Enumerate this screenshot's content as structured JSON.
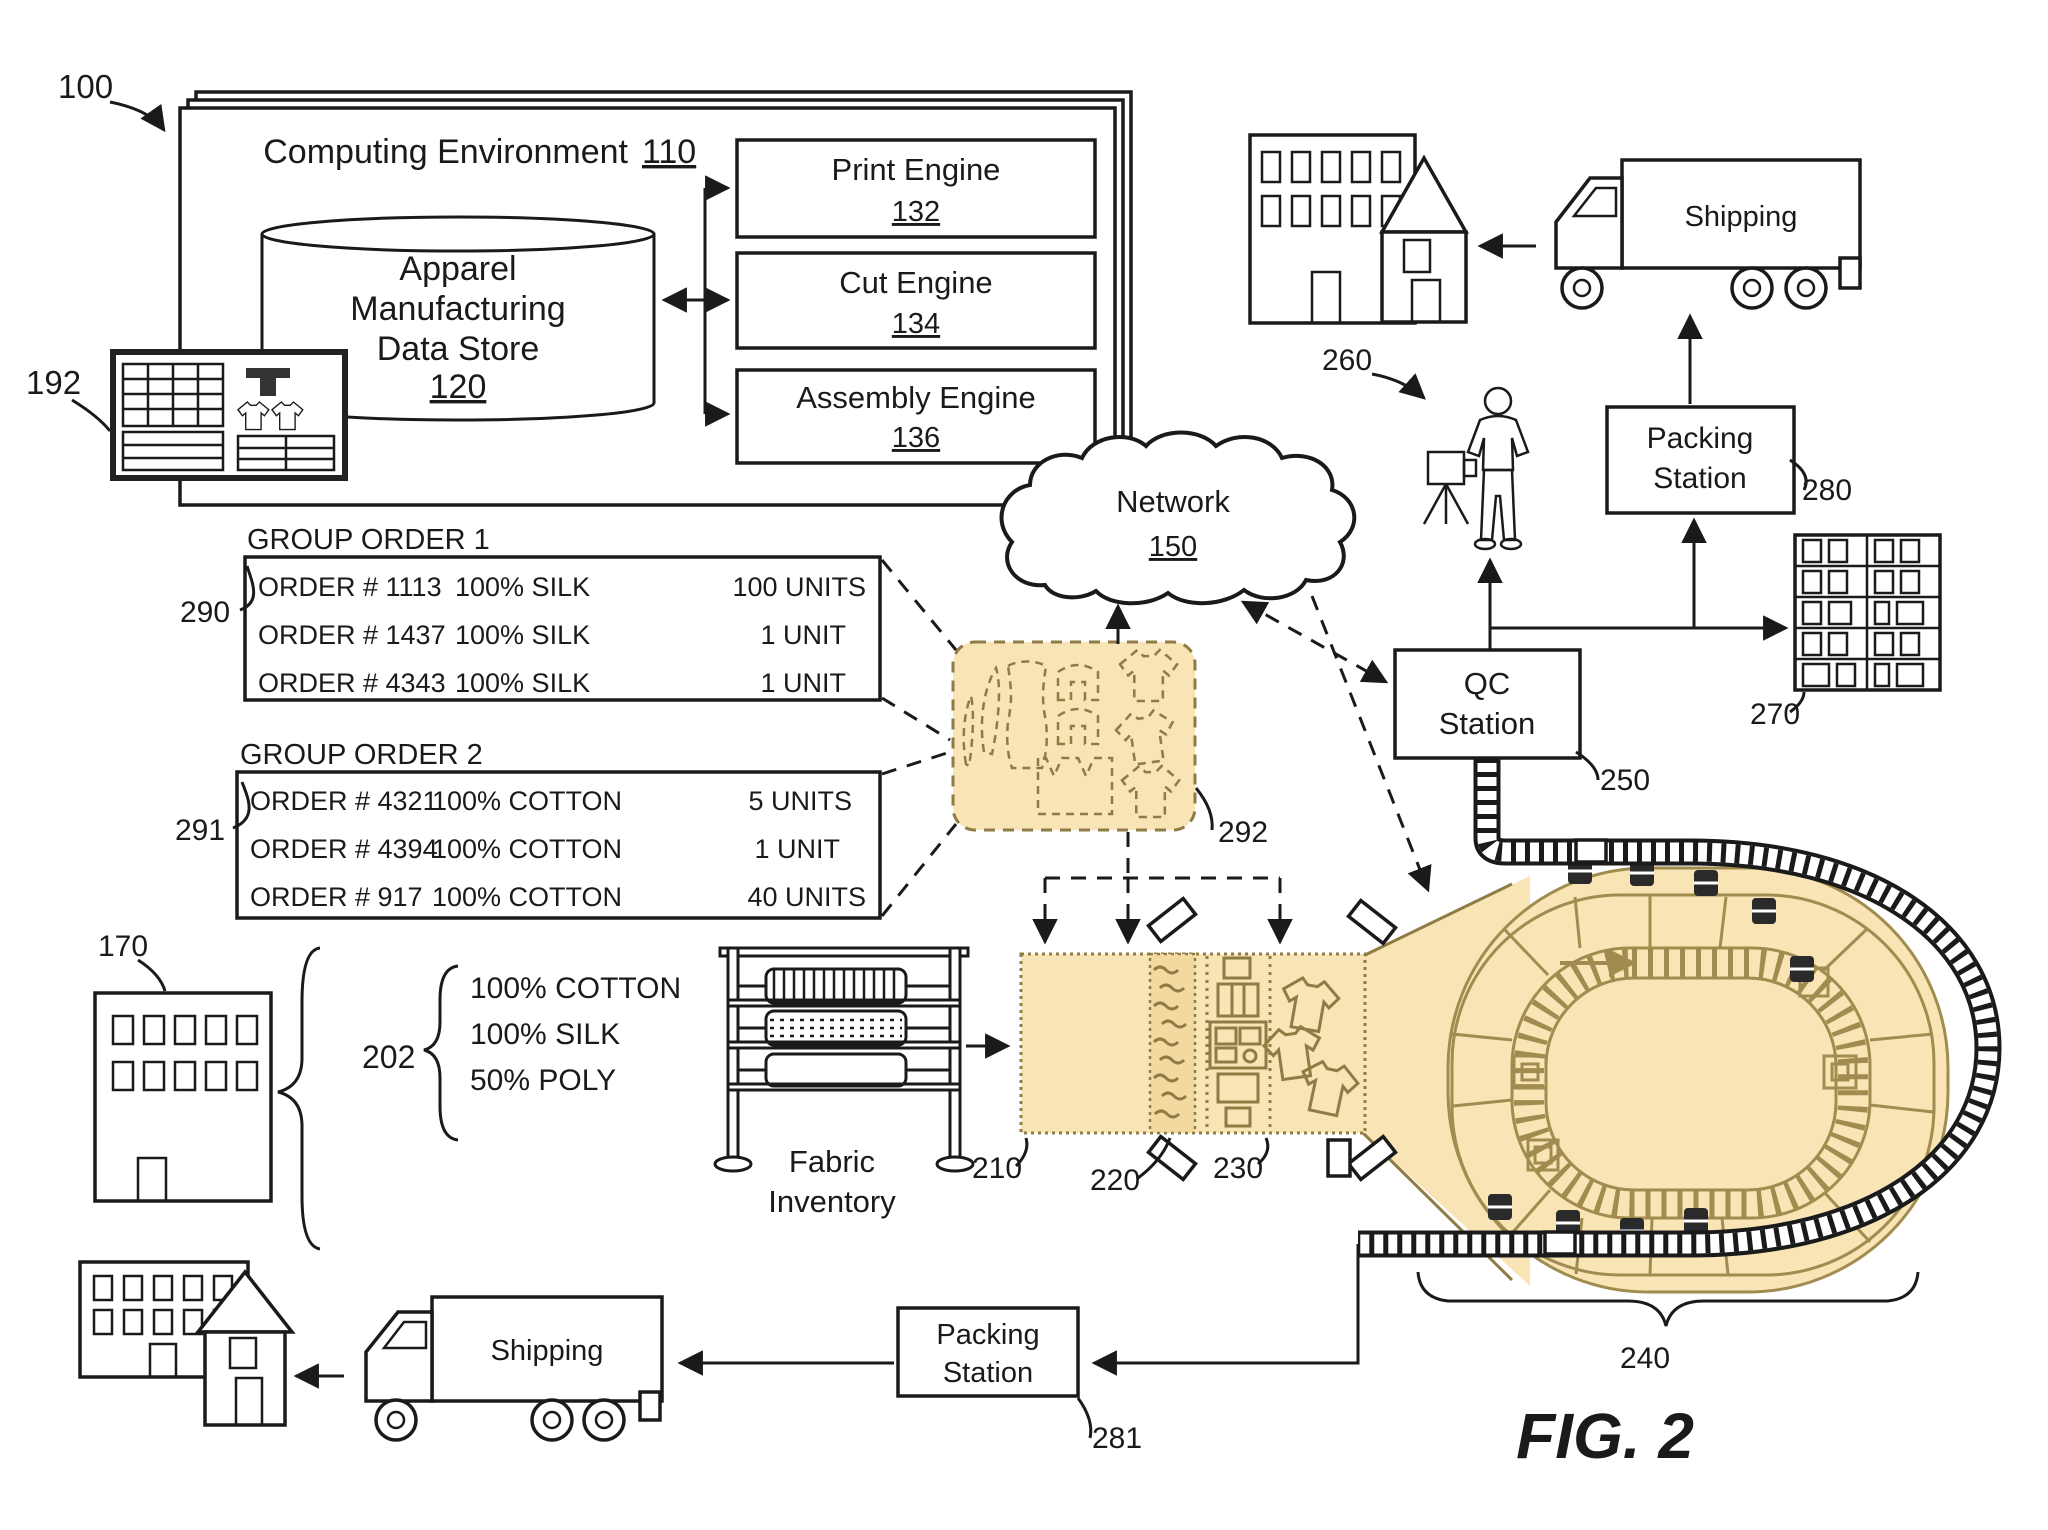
{
  "figure": {
    "system_ref": "100",
    "caption": "FIG. 2"
  },
  "colors": {
    "highlight_tan": "#f8e4b5",
    "outline_tan": "#a08c4f"
  },
  "computing_environment": {
    "title": "Computing Environment",
    "ref": "110",
    "data_store": {
      "line1": "Apparel",
      "line2": "Manufacturing",
      "line3": "Data Store",
      "ref": "120"
    },
    "engines": [
      {
        "name": "Print Engine",
        "ref": "132"
      },
      {
        "name": "Cut Engine",
        "ref": "134"
      },
      {
        "name": "Assembly Engine",
        "ref": "136"
      }
    ]
  },
  "client_screen": {
    "ref": "192"
  },
  "network": {
    "name": "Network",
    "ref": "150"
  },
  "group_order_1": {
    "title": "GROUP ORDER 1",
    "ref": "290",
    "rows": [
      [
        "ORDER # 1113",
        "100% SILK",
        "100 UNITS"
      ],
      [
        "ORDER # 1437",
        "100% SILK",
        "1 UNIT"
      ],
      [
        "ORDER # 4343",
        "100% SILK",
        "1 UNIT"
      ]
    ]
  },
  "group_order_2": {
    "title": "GROUP ORDER 2",
    "ref": "291",
    "rows": [
      [
        "ORDER # 4321",
        "100% COTTON",
        "5 UNITS"
      ],
      [
        "ORDER # 4394",
        "100% COTTON",
        "1 UNIT"
      ],
      [
        "ORDER # 917",
        "100% COTTON",
        "40 UNITS"
      ]
    ]
  },
  "pattern_layout": {
    "ref": "292"
  },
  "supplier_building": {
    "ref": "170"
  },
  "fabric_specs": {
    "ref": "202",
    "items": [
      "100% COTTON",
      "100% SILK",
      "50% POLY"
    ]
  },
  "fabric_inventory": {
    "line1": "Fabric",
    "line2": "Inventory"
  },
  "production_line": {
    "ref_print": "210",
    "ref_treat": "220",
    "ref_cut": "230"
  },
  "carousel": {
    "ref": "240"
  },
  "qc_station": {
    "line1": "QC",
    "line2": "Station",
    "ref": "250"
  },
  "inspection": {
    "ref": "260"
  },
  "storage_rack": {
    "ref": "270"
  },
  "packing_station_top": {
    "line1": "Packing",
    "line2": "Station",
    "ref": "280"
  },
  "packing_station_bottom": {
    "line1": "Packing",
    "line2": "Station",
    "ref": "281"
  },
  "shipping_top": {
    "label": "Shipping"
  },
  "shipping_bottom": {
    "label": "Shipping"
  }
}
